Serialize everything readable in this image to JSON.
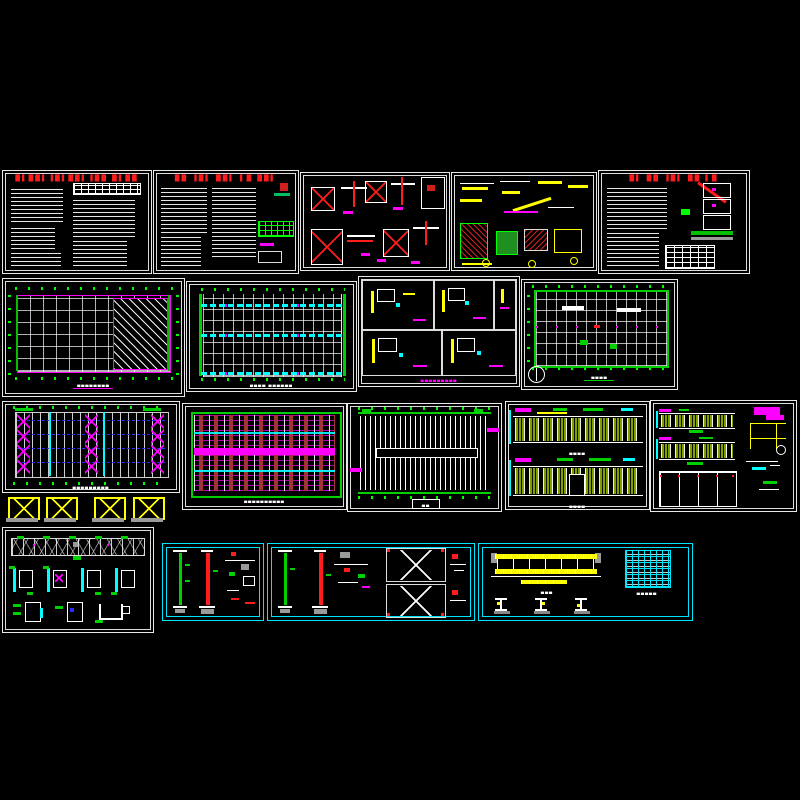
{
  "document": {
    "type": "cad-drawing-set-preview",
    "background": "#000000",
    "sheet_count": 18
  },
  "palette": {
    "line_white": "#e8e8e8",
    "title_red": "#ff1c1c",
    "annotation_green": "#00ff00",
    "accent_cyan": "#00ffff",
    "accent_magenta": "#ff00ff",
    "accent_yellow": "#ffff00",
    "brace_blue": "#2b2bff",
    "hatch_olive": "#7f9f00",
    "steel_gray": "#999999"
  },
  "sheets": {
    "s1": {
      "label": "general-notes-1",
      "title": "█▌██▌▐█▌██▌▐██ █▌██"
    },
    "s2": {
      "label": "general-notes-2",
      "title": "██ ▐█▌ ██▌ ▌█ ██▌"
    },
    "s3": {
      "label": "foundation-details"
    },
    "s4": {
      "label": "connection-details"
    },
    "s5": {
      "label": "notes-with-diagram",
      "title": "█▌ ██ ▐█▌ ██ ▌█"
    },
    "s6": {
      "label": "foundation-plan",
      "caption": "▄▄▄▄▄▄▄▄"
    },
    "s7": {
      "label": "tie-beam-plan",
      "caption": "▄▄▄▄ ▄▄▄▄▄▄"
    },
    "s8": {
      "label": "column-base-details",
      "caption": "▄▄▄▄▄▄▄▄▄"
    },
    "s9": {
      "label": "roof-plan",
      "caption": "▄▄▄▄"
    },
    "s10": {
      "label": "roof-bracing-plan",
      "caption": "▄▄▄▄▄▄▄▄▄"
    },
    "s11": {
      "label": "purlin-layout-plan",
      "caption": "▄▄▄▄▄▄▄▄▄▄"
    },
    "s12": {
      "label": "roof-sheeting-plan",
      "caption": "▄▄"
    },
    "s13": {
      "label": "building-elevations",
      "caption_top": "▄▄▄▄",
      "caption_bottom": "▄▄▄▄"
    },
    "s14": {
      "label": "elevation-and-details"
    },
    "s15": {
      "label": "truss-and-node-details"
    },
    "sa": {
      "label": "column-schedule-1"
    },
    "sb": {
      "label": "column-schedule-2"
    },
    "sc": {
      "label": "crane-beam-details",
      "caption": "▄▄▄",
      "table_caption": "▄▄▄▄▄"
    }
  }
}
